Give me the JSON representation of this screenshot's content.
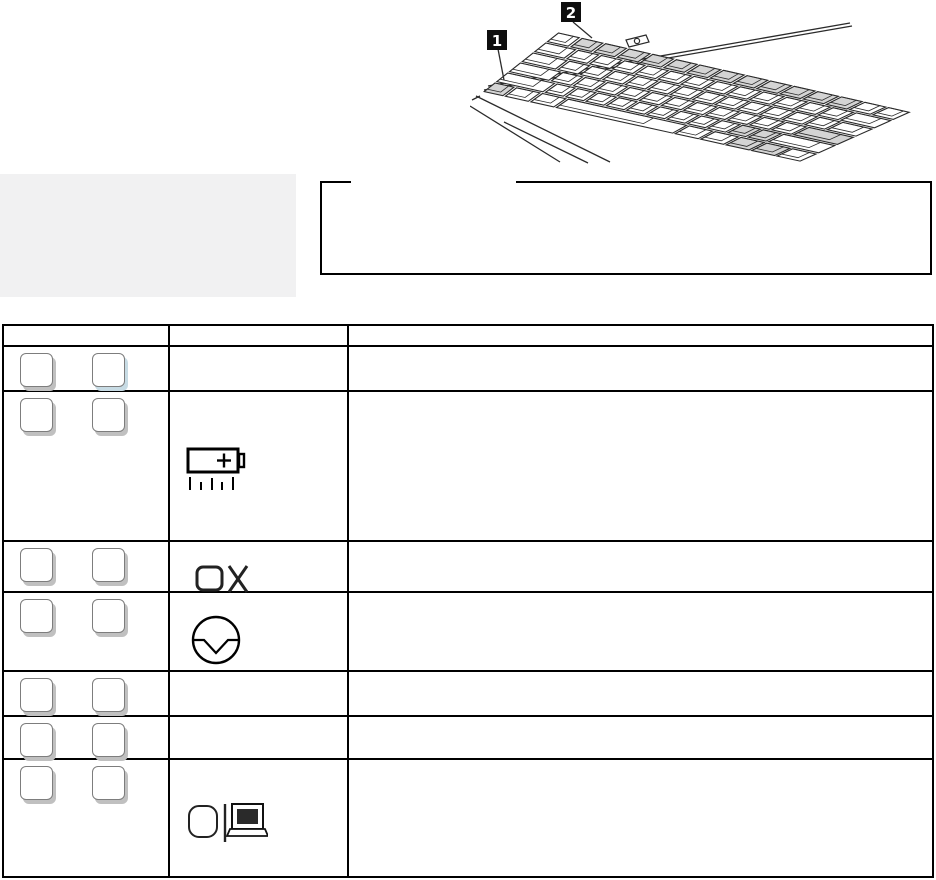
{
  "document": {
    "kind": "manual-page-scan",
    "visible_text_note": "page body text not rendered in scan; only line art, boxes and callout numerals visible"
  },
  "illustration": {
    "name": "keyboard-isometric-drawing",
    "callouts": [
      {
        "label": "1",
        "points_to": "fn-key"
      },
      {
        "label": "2",
        "points_to": "function-key-row"
      }
    ]
  },
  "colors": {
    "sidebar_box": "#f1f1f2",
    "shaded_key": "#d4d4d4",
    "key_shadow": "#c0c0c0",
    "key_shadow_alt": "#c7dbe4",
    "line": "#000000"
  },
  "note_box": {
    "title": "",
    "body": ""
  },
  "table": {
    "header_cells": [
      "",
      "",
      ""
    ],
    "rows": [
      {
        "keys": [
          "modifier-key",
          "function-key"
        ],
        "symbol_icon": "",
        "description": ""
      },
      {
        "keys": [
          "modifier-key",
          "function-key"
        ],
        "symbol_icon": "battery-gauge-icon",
        "description": ""
      },
      {
        "keys": [
          "modifier-key",
          "function-key"
        ],
        "symbol_icon": "lcd-off-icon",
        "description": ""
      },
      {
        "keys": [
          "modifier-key",
          "function-key"
        ],
        "symbol_icon": "standby-icon",
        "description": ""
      },
      {
        "keys": [
          "modifier-key",
          "function-key"
        ],
        "symbol_icon": "",
        "description": ""
      },
      {
        "keys": [
          "modifier-key",
          "function-key"
        ],
        "symbol_icon": "",
        "description": ""
      },
      {
        "keys": [
          "modifier-key",
          "function-key"
        ],
        "symbol_icon": "display-switch-icon",
        "description": ""
      }
    ]
  }
}
